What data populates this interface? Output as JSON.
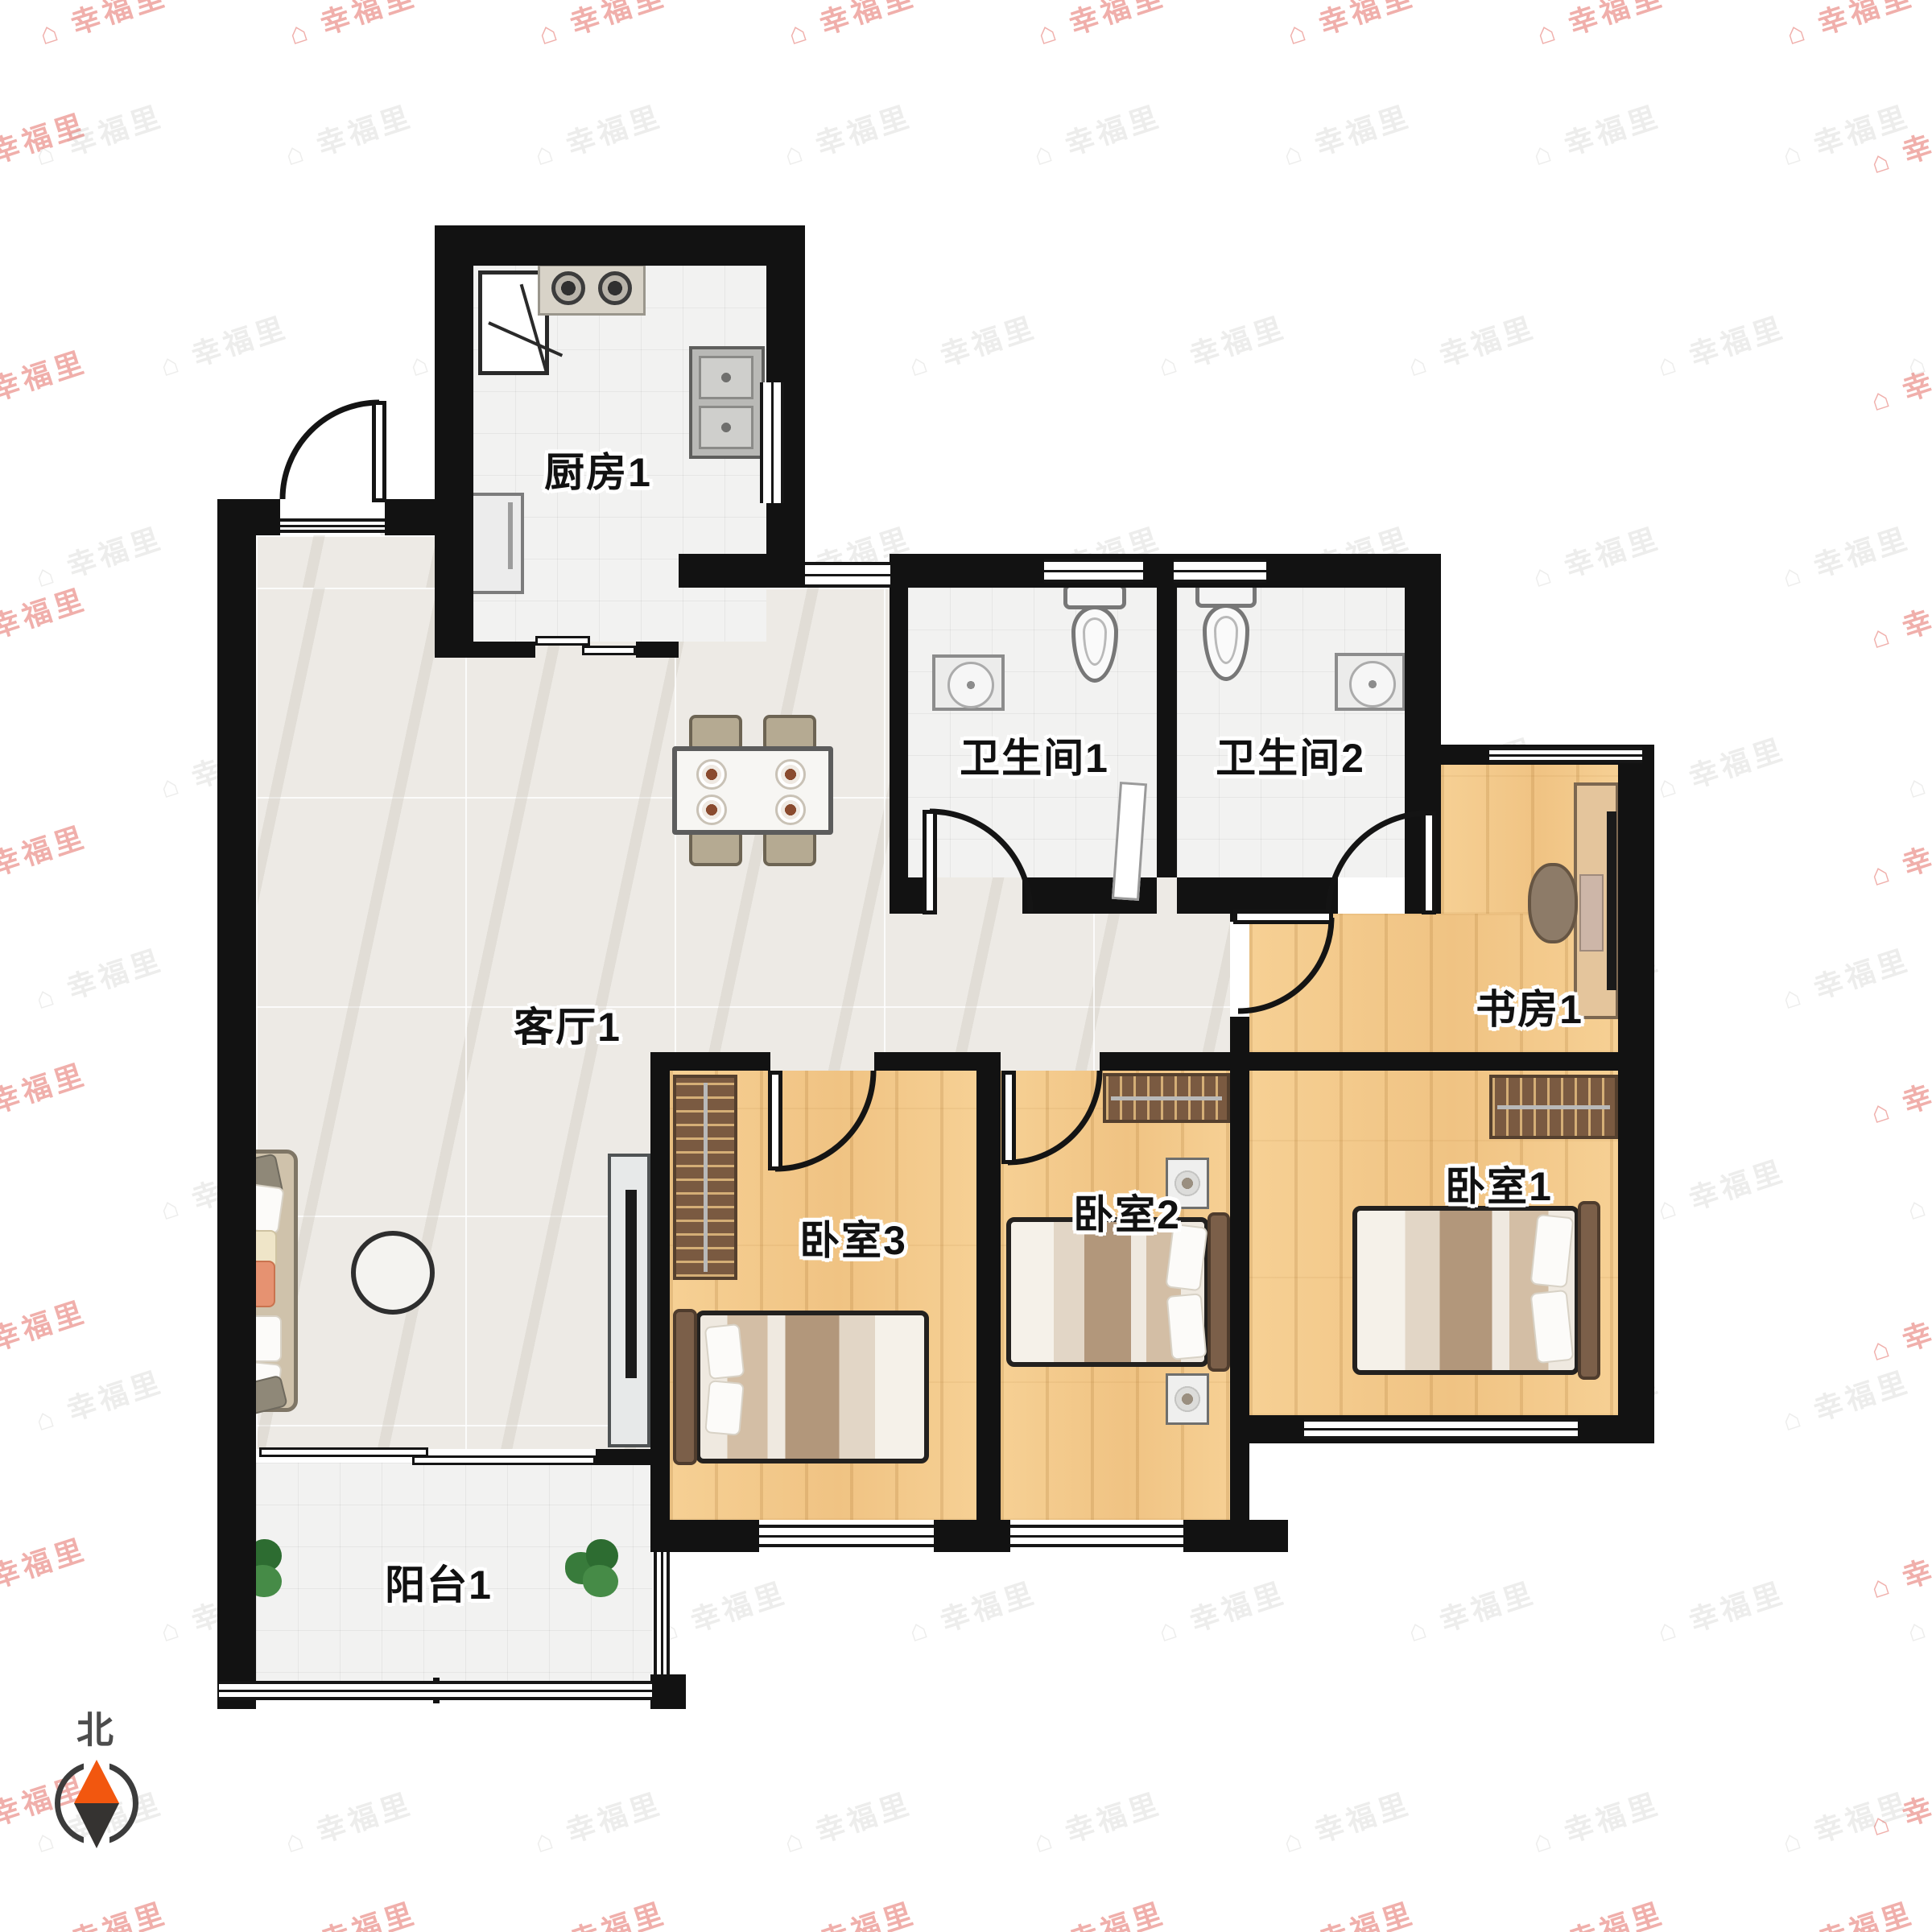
{
  "watermark": {
    "text": "幸福里",
    "icon": "⌂"
  },
  "compass": {
    "north": "北"
  },
  "rooms": {
    "kitchen": {
      "label": "厨房1"
    },
    "living": {
      "label": "客厅1"
    },
    "bathroom1": {
      "label": "卫生间1"
    },
    "bathroom2": {
      "label": "卫生间2"
    },
    "study": {
      "label": "书房1"
    },
    "bedroom1": {
      "label": "卧室1"
    },
    "bedroom2": {
      "label": "卧室2"
    },
    "bedroom3": {
      "label": "卧室3"
    },
    "balcony": {
      "label": "阳台1"
    }
  },
  "colors": {
    "wall": "#121212",
    "wood_floor": "#f3cb8d",
    "marble_floor": "#edeae5",
    "tile_floor": "#f2f2f1",
    "wardrobe": "#7a5a41",
    "compass_north": "#f2570f",
    "watermark_gray": "#ededec"
  }
}
